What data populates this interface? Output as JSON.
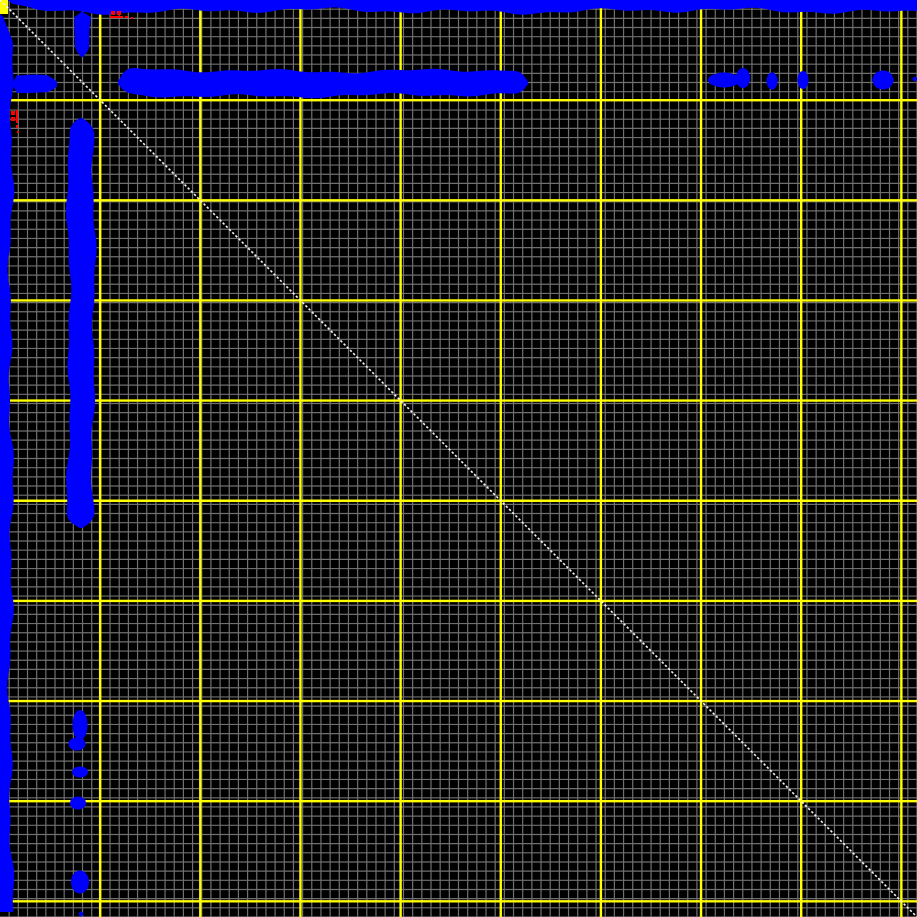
{
  "chart_data": {
    "type": "heatmap",
    "title": "",
    "xlabel": "",
    "ylabel": "",
    "x_range": [
      0,
      917
    ],
    "y_range": [
      0,
      917
    ],
    "grid_on": true,
    "legend": "none",
    "background": "#000000",
    "minor_grid": {
      "spacing": 9.17,
      "color": "#707070",
      "line_width": 1.2
    },
    "major_grid": {
      "spacing": 100.15,
      "count": 9,
      "color": "#ffff00",
      "line_width": 2.4
    },
    "origin_marker": {
      "x": 0,
      "y": 0,
      "width": 8,
      "height": 14,
      "color": "#ffff00"
    },
    "identity_diagonal": {
      "x1": 0,
      "y1": 0,
      "x2": 917,
      "y2": 917,
      "color": "#f4f4f4",
      "line_width": 1.6,
      "dash": "2.4 2.1"
    },
    "match_color": "#0000ff",
    "edge_bands": [
      {
        "name": "top-edge-band",
        "side": "top",
        "from": 8,
        "to": 917,
        "base": 11,
        "amp": 3.5,
        "seed": 1
      },
      {
        "name": "left-edge-band",
        "side": "left",
        "from": 14,
        "to": 912,
        "base": 11,
        "amp": 3.5,
        "seed": 2
      }
    ],
    "repeat_bands": [
      {
        "name": "horizontal-repeat-band",
        "orient": "h",
        "a0": 118,
        "a1": 528,
        "center": 83,
        "half": 12.5,
        "amp": 2.8,
        "taper0": 12,
        "taper1": 12,
        "seed": 3
      },
      {
        "name": "vertical-repeat-band",
        "orient": "v",
        "a0": 118,
        "a1": 528,
        "center": 81,
        "half": 12.5,
        "amp": 2.8,
        "taper0": 12,
        "taper1": 12,
        "seed": 4
      },
      {
        "name": "left-arm-band",
        "orient": "h",
        "a0": 12,
        "a1": 58,
        "center": 84,
        "half": 8.5,
        "amp": 2.0,
        "taper0": 2,
        "taper1": 11,
        "seed": 5
      },
      {
        "name": "top-arm-band",
        "orient": "v",
        "a0": 12,
        "a1": 57,
        "center": 82,
        "half": 8.5,
        "amp": 2.0,
        "taper0": 2,
        "taper1": 11,
        "seed": 6
      }
    ],
    "match_blobs": [
      {
        "cx": 724,
        "cy": 80,
        "rx": 16,
        "ry": 7.5
      },
      {
        "cx": 743,
        "cy": 78,
        "rx": 7,
        "ry": 10
      },
      {
        "cx": 772,
        "cy": 81,
        "rx": 5.5,
        "ry": 8.5
      },
      {
        "cx": 803,
        "cy": 80,
        "rx": 5.5,
        "ry": 9
      },
      {
        "cx": 883,
        "cy": 80,
        "rx": 10.5,
        "ry": 9.5
      },
      {
        "cx": 915,
        "cy": 79,
        "rx": 2.5,
        "ry": 2.2
      },
      {
        "cx": 80,
        "cy": 725,
        "rx": 7.5,
        "ry": 15
      },
      {
        "cx": 77,
        "cy": 744,
        "rx": 8.5,
        "ry": 6.5
      },
      {
        "cx": 80,
        "cy": 772,
        "rx": 8,
        "ry": 5.5
      },
      {
        "cx": 78,
        "cy": 803,
        "rx": 8,
        "ry": 6.5
      },
      {
        "cx": 80,
        "cy": 882,
        "rx": 9,
        "ry": 11.5
      },
      {
        "cx": 81,
        "cy": 914,
        "rx": 2.2,
        "ry": 2.5
      }
    ],
    "annotations": {
      "color": "#ff0000",
      "marks": [
        [
          111,
          11,
          4,
          4
        ],
        [
          117,
          11,
          4,
          4
        ],
        [
          110,
          16,
          13,
          2
        ],
        [
          125,
          16,
          3,
          2
        ],
        [
          131,
          17,
          2,
          2
        ],
        [
          11,
          111,
          4,
          4
        ],
        [
          11,
          117,
          4,
          4
        ],
        [
          16,
          110,
          2,
          13
        ],
        [
          16,
          125,
          2,
          3
        ],
        [
          17,
          131,
          2,
          2
        ]
      ]
    }
  }
}
